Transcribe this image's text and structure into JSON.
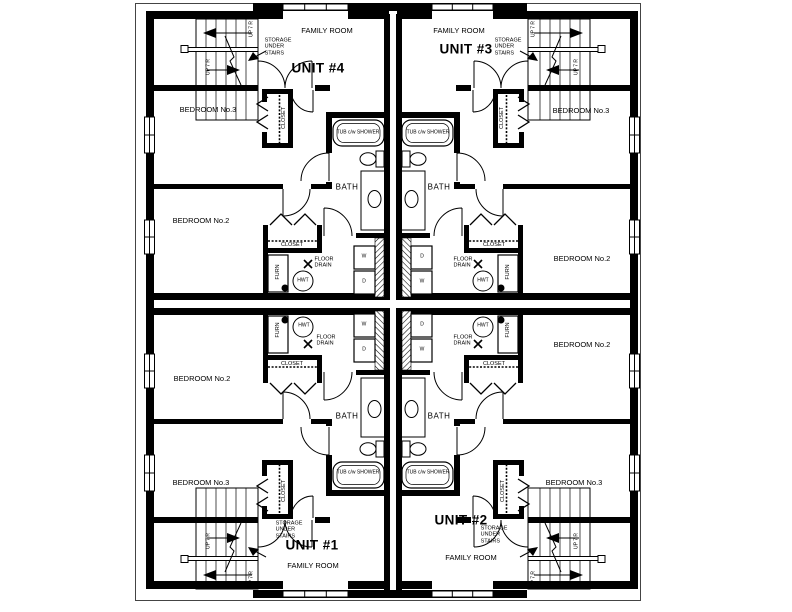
{
  "units": [
    {
      "name": "UNIT #1"
    },
    {
      "name": "UNIT #2"
    },
    {
      "name": "UNIT #3"
    },
    {
      "name": "UNIT #4"
    }
  ],
  "labels": {
    "family_room": "FAMILY ROOM",
    "bedroom_2": "BEDROOM No.2",
    "bedroom_3": "BEDROOM No.3",
    "bath": "BATH",
    "closet": "CLOSET",
    "storage_under_stairs": "STORAGE\nUNDER\nSTAIRS",
    "tub_shower": "TUB c/w SHOWER",
    "furnace": "FURN",
    "hot_water_tank": "HWT",
    "floor_drain": "FLOOR\nDRAIN",
    "washer": "W",
    "dryer": "D",
    "stairs_up": "UP 7 R"
  },
  "colors": {
    "line": "#000000",
    "background": "#ffffff"
  }
}
